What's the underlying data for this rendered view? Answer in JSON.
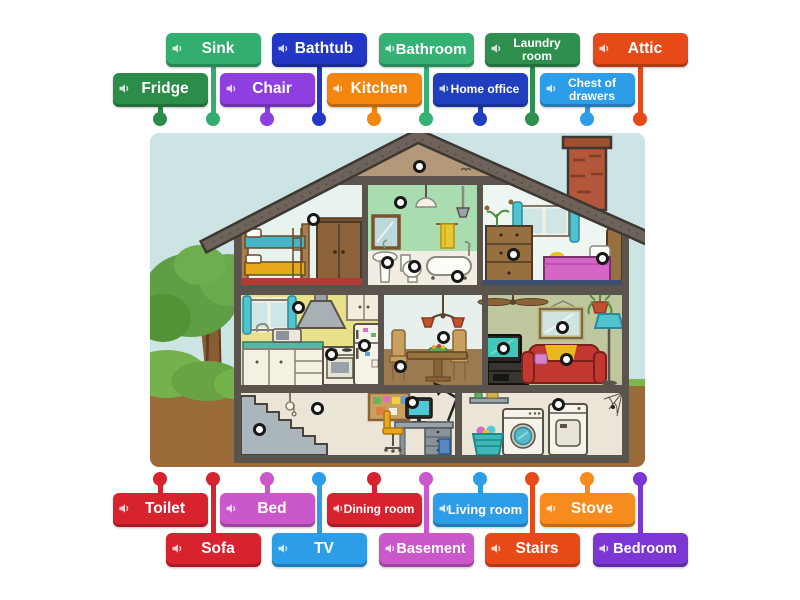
{
  "icons": {
    "label_icon": "speaker"
  },
  "labels": [
    {
      "text": "Sink",
      "color": "#33ae6e",
      "row": "t1",
      "cx": 213,
      "fs": 15.5,
      "wrap": false
    },
    {
      "text": "Bathtub",
      "color": "#2337c6",
      "row": "t1",
      "cx": 319,
      "fs": 15.5,
      "wrap": false
    },
    {
      "text": "Bathroom",
      "color": "#35b173",
      "row": "t1",
      "cx": 426,
      "fs": 15,
      "wrap": false
    },
    {
      "text": "Laundry room",
      "color": "#2f8f4f",
      "row": "t1",
      "cx": 532,
      "fs": 12,
      "wrap": true
    },
    {
      "text": "Attic",
      "color": "#e64a19",
      "row": "t1",
      "cx": 640,
      "fs": 15.5,
      "wrap": false
    },
    {
      "text": "Fridge",
      "color": "#2c8c49",
      "row": "t2",
      "cx": 160,
      "fs": 15.5,
      "wrap": false
    },
    {
      "text": "Chair",
      "color": "#8f3fe0",
      "row": "t2",
      "cx": 267,
      "fs": 15.5,
      "wrap": false
    },
    {
      "text": "Kitchen",
      "color": "#f4850d",
      "row": "t2",
      "cx": 374,
      "fs": 15.5,
      "wrap": false
    },
    {
      "text": "Home office",
      "color": "#1f3fbe",
      "row": "t2",
      "cx": 480,
      "fs": 12,
      "wrap": true
    },
    {
      "text": "Chest of drawers",
      "color": "#2d9de8",
      "row": "t2",
      "cx": 587,
      "fs": 12,
      "wrap": true
    },
    {
      "text": "Toilet",
      "color": "#d7232e",
      "row": "b1",
      "cx": 160,
      "fs": 15.5,
      "wrap": false
    },
    {
      "text": "Bed",
      "color": "#ca58ca",
      "row": "b1",
      "cx": 267,
      "fs": 15.5,
      "wrap": false
    },
    {
      "text": "Dining room",
      "color": "#d7232e",
      "row": "b1",
      "cx": 374,
      "fs": 12,
      "wrap": true
    },
    {
      "text": "Living room",
      "color": "#2d9de8",
      "row": "b1",
      "cx": 480,
      "fs": 13,
      "wrap": false
    },
    {
      "text": "Stove",
      "color": "#f78c1e",
      "row": "b1",
      "cx": 587,
      "fs": 15.5,
      "wrap": false
    },
    {
      "text": "Sofa",
      "color": "#d7232e",
      "row": "b2",
      "cx": 213,
      "fs": 15.5,
      "wrap": false
    },
    {
      "text": "TV",
      "color": "#2d9de8",
      "row": "b2",
      "cx": 319,
      "fs": 15.5,
      "wrap": false
    },
    {
      "text": "Basement",
      "color": "#ca58ca",
      "row": "b2",
      "cx": 426,
      "fs": 14.5,
      "wrap": false
    },
    {
      "text": "Stairs",
      "color": "#e64a19",
      "row": "b2",
      "cx": 532,
      "fs": 15.5,
      "wrap": false
    },
    {
      "text": "Bedroom",
      "color": "#7b36d4",
      "row": "b2",
      "cx": 640,
      "fs": 14.5,
      "wrap": false
    }
  ],
  "pins": [
    {
      "name": "attic",
      "x": 419,
      "y": 166
    },
    {
      "name": "bathroom-wall",
      "x": 400,
      "y": 202
    },
    {
      "name": "kids-bedroom",
      "x": 313,
      "y": 219
    },
    {
      "name": "bathroom-sink",
      "x": 387,
      "y": 262
    },
    {
      "name": "toilet",
      "x": 414,
      "y": 266
    },
    {
      "name": "bathtub",
      "x": 457,
      "y": 276
    },
    {
      "name": "chest-of-drawers",
      "x": 513,
      "y": 254
    },
    {
      "name": "bed",
      "x": 602,
      "y": 258
    },
    {
      "name": "kitchen-wall",
      "x": 298,
      "y": 307
    },
    {
      "name": "stove",
      "x": 331,
      "y": 354
    },
    {
      "name": "fridge",
      "x": 364,
      "y": 345
    },
    {
      "name": "dining-chandelier",
      "x": 443,
      "y": 337
    },
    {
      "name": "dining-chair",
      "x": 400,
      "y": 366
    },
    {
      "name": "living-room-mirror",
      "x": 562,
      "y": 327
    },
    {
      "name": "tv",
      "x": 503,
      "y": 348
    },
    {
      "name": "sofa",
      "x": 566,
      "y": 359
    },
    {
      "name": "office-desk",
      "x": 412,
      "y": 402
    },
    {
      "name": "basement-wall",
      "x": 317,
      "y": 408
    },
    {
      "name": "stairs",
      "x": 259,
      "y": 429
    },
    {
      "name": "laundry-room",
      "x": 558,
      "y": 404
    }
  ],
  "scene": {
    "sky": "#cde4e5",
    "ground": "#9b6a39",
    "grass": "#7cb84e",
    "roof": "#6e635a",
    "roof_edge": "#3e3832",
    "attic": "#b39879",
    "beam": "#5b544c",
    "kids_wall": "#e8f3f0",
    "bath_wall": "#a9dcae",
    "bath_wainscot": "#f1ede3",
    "bedroom_wall": "#eef6f2",
    "kitchen_wall": "#e9e08a",
    "dining_wall": "#e7f0ed",
    "dining_wainscot": "#9a7a4e",
    "living_wall": "#bec79d",
    "basement_wall": "#ebe5d7",
    "chimney": "#b2573a",
    "frame": "#ffffff",
    "pin_fill": "#ffffff",
    "pin_border": "#181818"
  }
}
